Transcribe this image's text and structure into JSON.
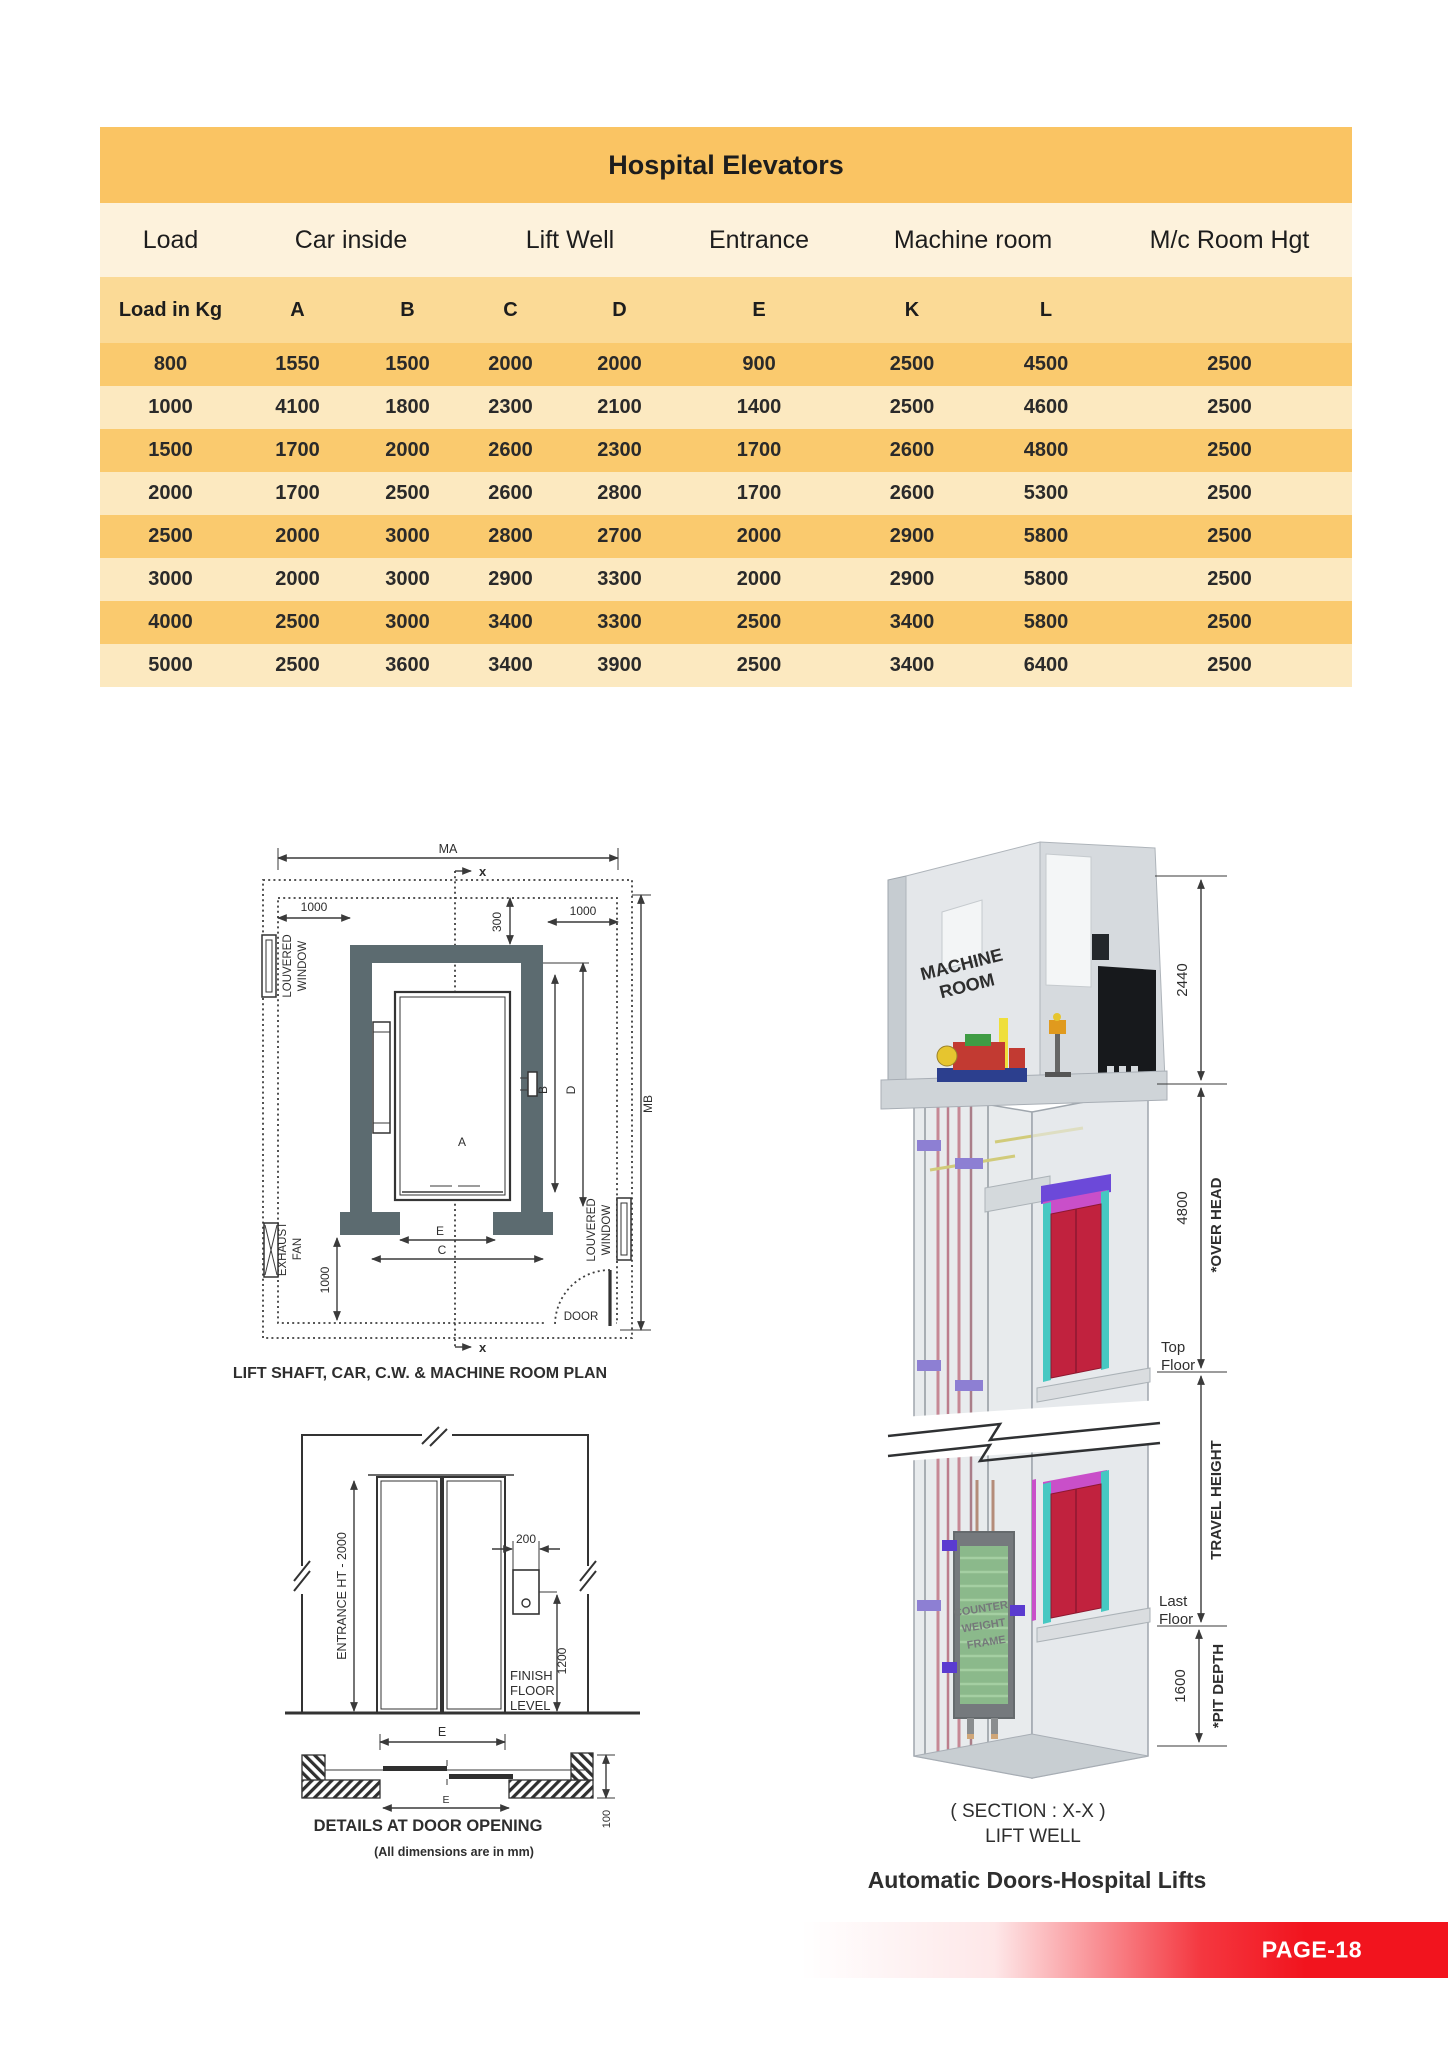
{
  "table": {
    "title": "Hospital Elevators",
    "group_headers": [
      "Load",
      "Car inside",
      "Lift Well",
      "Entrance",
      "Machine room",
      "M/c Room Hgt"
    ],
    "col_headers": [
      "Load in Kg",
      "A",
      "B",
      "C",
      "D",
      "E",
      "K",
      "L",
      ""
    ],
    "rows": [
      [
        "800",
        "1550",
        "1500",
        "2000",
        "2000",
        "900",
        "2500",
        "4500",
        "2500"
      ],
      [
        "1000",
        "4100",
        "1800",
        "2300",
        "2100",
        "1400",
        "2500",
        "4600",
        "2500"
      ],
      [
        "1500",
        "1700",
        "2000",
        "2600",
        "2300",
        "1700",
        "2600",
        "4800",
        "2500"
      ],
      [
        "2000",
        "1700",
        "2500",
        "2600",
        "2800",
        "1700",
        "2600",
        "5300",
        "2500"
      ],
      [
        "2500",
        "2000",
        "3000",
        "2800",
        "2700",
        "2000",
        "2900",
        "5800",
        "2500"
      ],
      [
        "3000",
        "2000",
        "3000",
        "2900",
        "3300",
        "2000",
        "2900",
        "5800",
        "2500"
      ],
      [
        "4000",
        "2500",
        "3000",
        "3400",
        "3300",
        "2500",
        "3400",
        "5800",
        "2500"
      ],
      [
        "5000",
        "2500",
        "3600",
        "3400",
        "3900",
        "2500",
        "3400",
        "6400",
        "2500"
      ]
    ]
  },
  "plan": {
    "caption": "LIFT SHAFT, CAR, C.W. & MACHINE ROOM PLAN",
    "labels": {
      "ma": "MA",
      "mb": "MB",
      "a": "A",
      "b": "B",
      "c": "C",
      "d": "D",
      "e": "E",
      "x": "x",
      "dim_1000": "1000",
      "dim_300": "300",
      "louvered": [
        "LOUVERED",
        "WINDOW"
      ],
      "exhaust": [
        "EXHAUST",
        "FAN"
      ],
      "door": "DOOR"
    }
  },
  "door_detail": {
    "entrance_height": "ENTRANCE HT - 2000",
    "dim_200": "200",
    "dim_1200": "1200",
    "dim_100": "100",
    "finish_floor": [
      "FINISH",
      "FLOOR",
      "LEVEL"
    ],
    "dim_e": "E",
    "caption": "DETAILS AT DOOR OPENING",
    "note": "(All dimensions are in mm)"
  },
  "section": {
    "machine_room": [
      "MACHINE",
      "ROOM"
    ],
    "dim_2440": "2440",
    "dim_4800": "4800",
    "dim_1600": "1600",
    "over_head": "*OVER HEAD",
    "travel_height": "TRAVEL HEIGHT",
    "pit_depth": "*PIT DEPTH",
    "top_floor": [
      "Top",
      "Floor"
    ],
    "last_floor": [
      "Last",
      "Floor"
    ],
    "counterweight": [
      "COUNTER",
      "WEIGHT",
      "FRAME"
    ],
    "caption_line1": "( SECTION : X-X )",
    "caption_line2": "LIFT WELL",
    "title": "Automatic Doors-Hospital Lifts"
  },
  "footer": {
    "page_label": "PAGE-18"
  },
  "colors": {
    "title_band": "#FAC463",
    "group_row": "#FDF2DC",
    "subheader_row": "#FBDA96",
    "row_dark": "#FACA6E",
    "row_light": "#FCE9C0",
    "footer_red": "#F2141E",
    "wall_gray": "#5C6B70",
    "door_red": "#C1223E",
    "cw_green": "#56A44E",
    "bracket_purple": "#5A3BD0"
  }
}
